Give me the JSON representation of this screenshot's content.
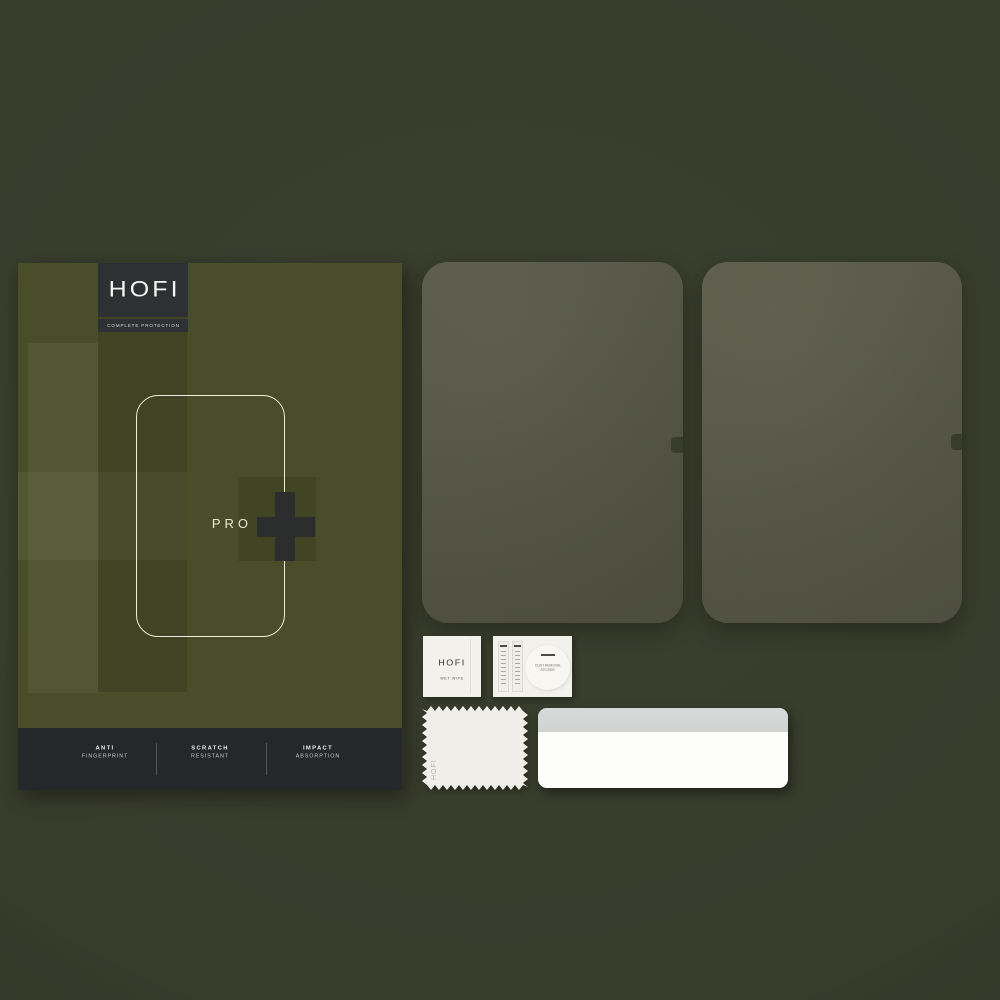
{
  "brand_plate": {
    "brand": "HOFI",
    "tagline": "COMPLETE PROTECTION"
  },
  "box": {
    "series_label": "PRO",
    "features": [
      {
        "top": "ANTI",
        "bottom": "FINGERPRINT"
      },
      {
        "top": "SCRATCH",
        "bottom": "RESISTANT"
      },
      {
        "top": "IMPACT",
        "bottom": "ABSORPTION"
      }
    ]
  },
  "glass_protectors": {
    "count": 2
  },
  "accessories": {
    "wet_wipe": {
      "brand": "HOFI",
      "label": "WET WIPE"
    },
    "sticker_packet": {
      "guide_strip_count": 2,
      "sticker_label_line1": "DUST REMOVAL",
      "sticker_label_line2": "STICKER"
    },
    "cloth": {
      "brand": "HOFI"
    }
  },
  "icons": {
    "box_plus": "plus-icon",
    "camera_notch": "camera-notch-icon"
  },
  "colors": {
    "background": "#383c2b",
    "box_olive": "#4a4d29",
    "plate_dark": "#2d3134",
    "feature_bar_dark": "#25272a",
    "outline_cream": "#efedda",
    "plus_dark": "#2b2e2d",
    "glass_tint": "#545544",
    "paper_white": "#f2f1ec",
    "card_gray": "#d5d6d6"
  }
}
